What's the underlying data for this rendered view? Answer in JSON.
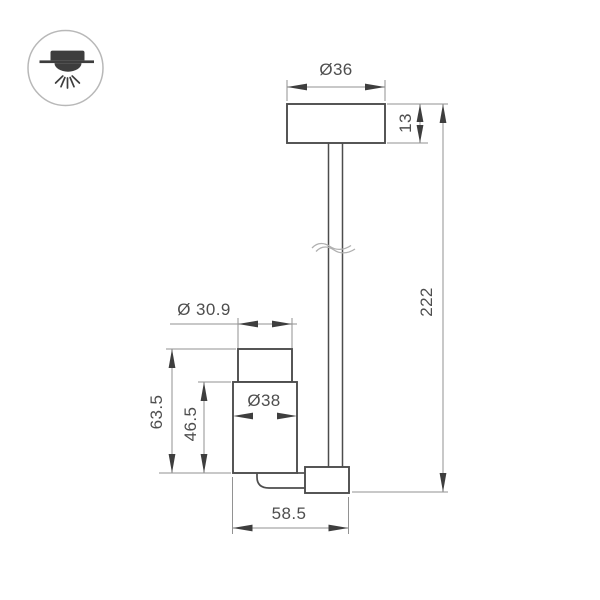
{
  "icon": {
    "name": "ceiling-light-icon"
  },
  "colors": {
    "background": "#ffffff",
    "outline": "#4d4d4d",
    "dimension_line": "#929292",
    "arrow": "#3e3e3e",
    "text": "#4e4e4e",
    "icon_fill": "#3d3d3d",
    "icon_circle": "#b8b8b8",
    "break_line": "#b0b0b0"
  },
  "dimensions": {
    "canopy_diameter": "Ø36",
    "canopy_height": "13",
    "stem_length": "222",
    "head_top_diameter": "Ø 30.9",
    "head_body_diameter": "Ø38",
    "head_overall_height": "63.5",
    "head_body_height": "46.5",
    "head_overall_width": "58.5"
  }
}
